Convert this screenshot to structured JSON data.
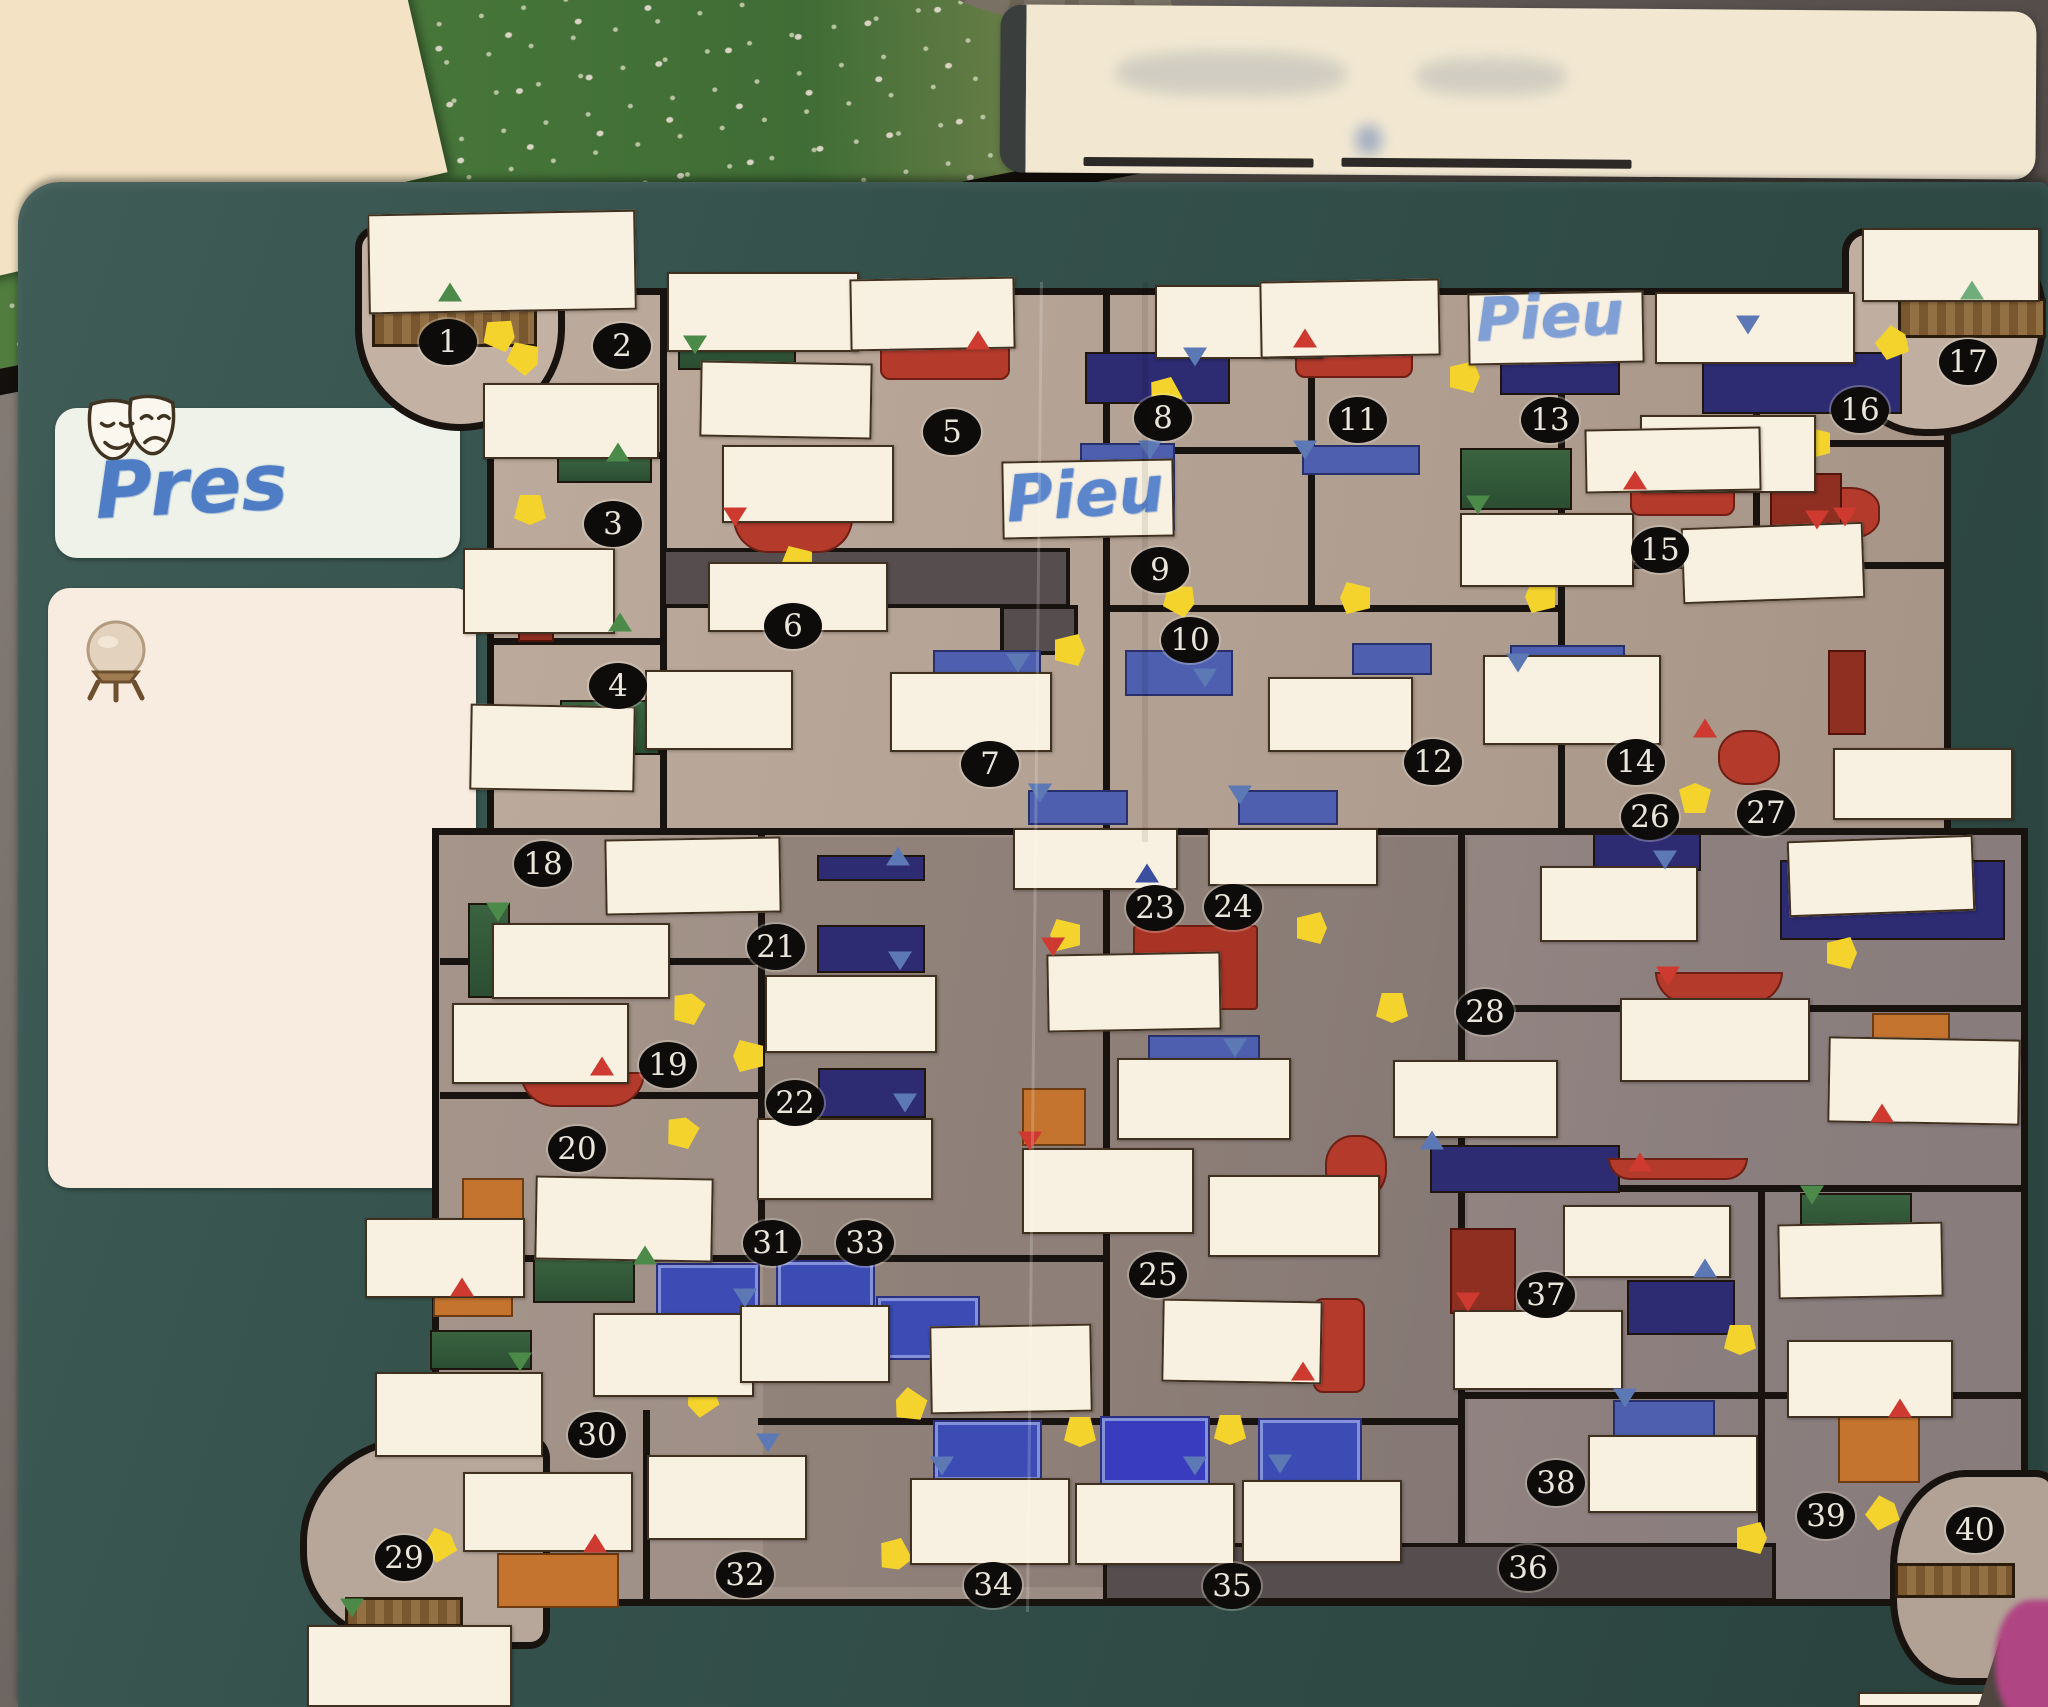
{
  "handwriting": {
    "masks_card": "Pres",
    "center_room_label": "Pieu",
    "top_right_room_label": "Pieu"
  },
  "icons": {
    "theater_masks": "theater-masks-icon",
    "crystal_ball": "crystal-ball-icon"
  },
  "colors": {
    "board_teal": "#35514c",
    "floor_tan": "#b3a193",
    "floor_gray": "#9a8b84",
    "wall_black": "#191310",
    "label_white": "#f8f0e0",
    "door_yellow": "#f3d32c",
    "marker_green": "#4c8a4a",
    "marker_red": "#cf3a30",
    "marker_blue": "#5d79b5",
    "marker_navy": "#2d2b72",
    "ink_blue": "#4e7cc5",
    "other_board_green": "#4a7a3e",
    "notecard_cream": "#f2e8d2",
    "pink_object": "#b04583"
  },
  "rooms": [
    "1",
    "2",
    "3",
    "4",
    "5",
    "6",
    "7",
    "8",
    "9",
    "10",
    "11",
    "12",
    "13",
    "14",
    "15",
    "16",
    "17",
    "18",
    "19",
    "20",
    "21",
    "22",
    "23",
    "24",
    "25",
    "26",
    "27",
    "28",
    "29",
    "30",
    "31",
    "32",
    "33",
    "34",
    "35",
    "36",
    "37",
    "38",
    "39",
    "40"
  ]
}
